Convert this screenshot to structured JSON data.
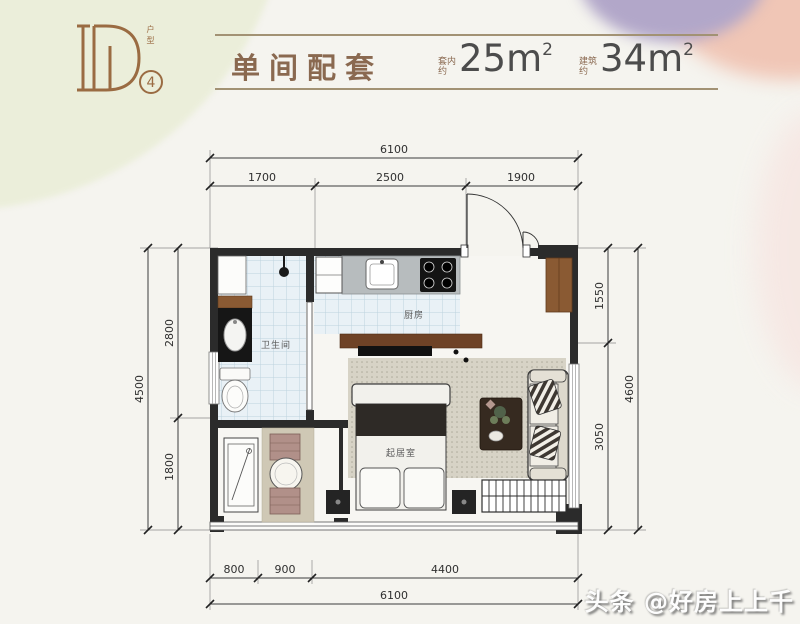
{
  "header": {
    "logo_letter": "D",
    "logo_vertical_label": "户型",
    "logo_number": "4",
    "title": "单间配套",
    "areas": [
      {
        "label_top": "套内",
        "label_bottom": "约",
        "value": "25",
        "unit": "m",
        "sup": "2"
      },
      {
        "label_top": "建筑",
        "label_bottom": "约",
        "value": "34",
        "unit": "m",
        "sup": "2"
      }
    ]
  },
  "plan": {
    "dimensions": {
      "top_total": "6100",
      "top_segments": [
        "1700",
        "2500",
        "1900"
      ],
      "left_total": "4500",
      "left_segments": [
        "2800",
        "1800"
      ],
      "right_segments": [
        "1550",
        "3050"
      ],
      "right_total": "4600",
      "bottom_segments": [
        "800",
        "900",
        "4400"
      ],
      "bottom_total": "6100"
    },
    "rooms": [
      {
        "name": "卫生间"
      },
      {
        "name": "厨房"
      },
      {
        "name": "起居室"
      }
    ]
  },
  "watermark": "头条 @好房上上千",
  "colors": {
    "accent_brown": "#8a6950",
    "logo_bronze": "#9a6b42",
    "wall": "#2b2b2b",
    "tile": "#e9f1f6",
    "wood": "#8a5a33"
  }
}
